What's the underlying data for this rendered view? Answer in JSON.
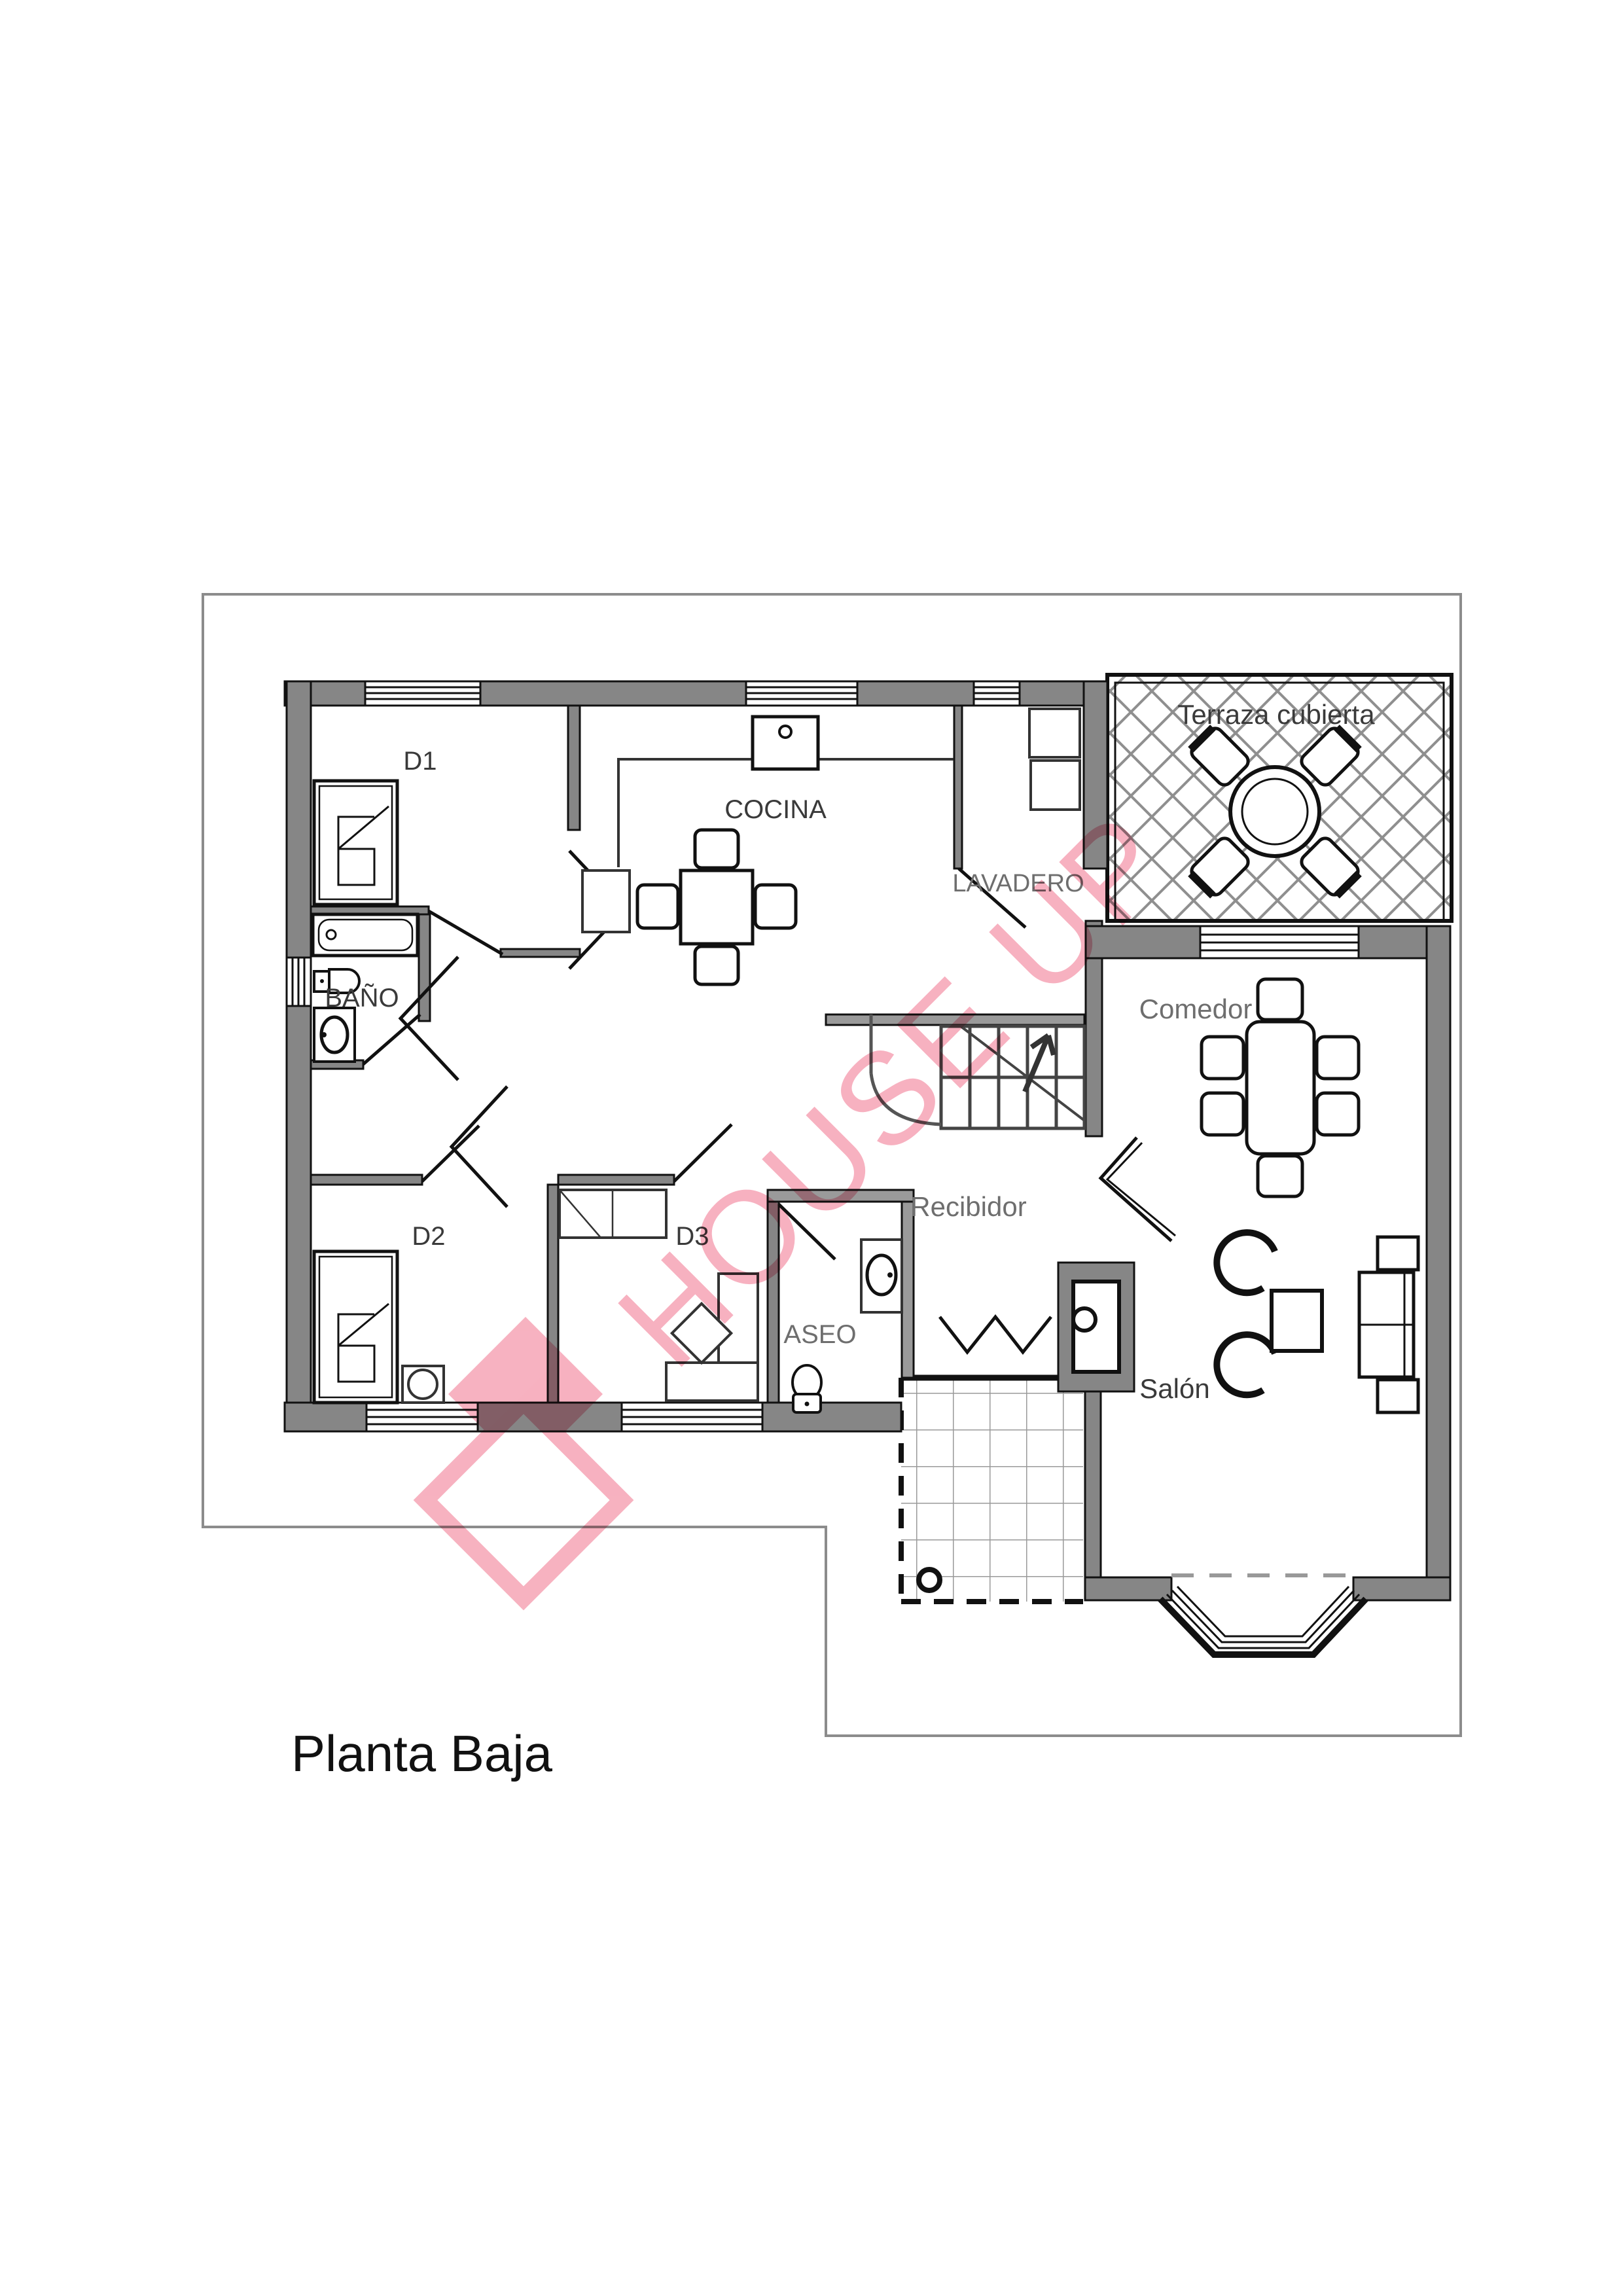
{
  "title": {
    "text": "Planta Baja"
  },
  "watermark": {
    "text": "HOUSE UP",
    "color": "#f2829a"
  },
  "sheet": {
    "border_color": "#8c8c8c",
    "background": "#ffffff"
  },
  "palette": {
    "wall_gray": "#868686",
    "line_black": "#111111",
    "hatch_gray": "#8f8f8f",
    "tile_gray": "#9a9a9a"
  },
  "rooms": {
    "d1": {
      "label": "D1"
    },
    "cocina": {
      "label": "COCINA"
    },
    "lavadero": {
      "label": "LAVADERO"
    },
    "terraza": {
      "label": "Terraza cubierta"
    },
    "bano": {
      "label": "BAÑO"
    },
    "comedor": {
      "label": "Comedor"
    },
    "recibidor": {
      "label": "Recibidor"
    },
    "d2": {
      "label": "D2"
    },
    "d3": {
      "label": "D3"
    },
    "aseo": {
      "label": "ASEO"
    },
    "salon": {
      "label": "Salón"
    }
  }
}
